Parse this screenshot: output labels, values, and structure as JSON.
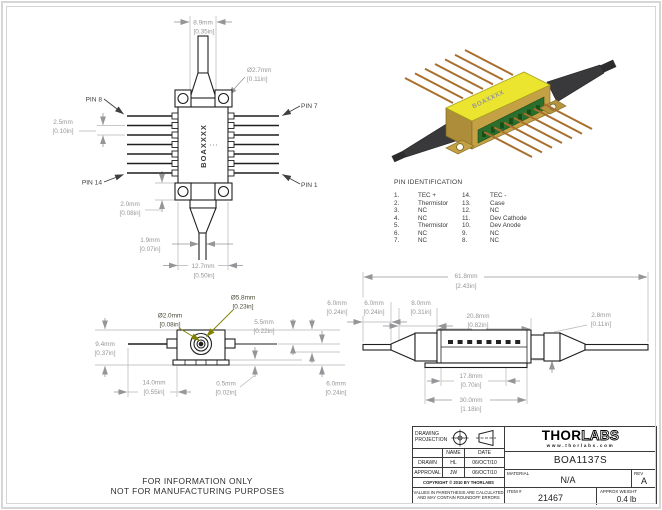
{
  "colors": {
    "part_line": "#1f1f1f",
    "dim_gray": "#96969a",
    "olive_accent": "#7f7f00",
    "lid_yellow": "#ece52f"
  },
  "watermark": {
    "line1": "FOR INFORMATION ONLY",
    "line2": "NOT FOR MANUFACTURING PURPOSES"
  },
  "top_view": {
    "label": "BOAXXXX",
    "pins": {
      "p8": "PIN 8",
      "p7": "PIN 7",
      "p14": "PIN 14",
      "p1": "PIN 1"
    },
    "dims": {
      "width": {
        "mm": "8.9mm",
        "in": "[0.35in]"
      },
      "hole": {
        "mm": "Ø2.7mm",
        "in": "[0.11in]"
      },
      "pitch": {
        "mm": "2.5mm",
        "in": "[0.10in]"
      },
      "ear": {
        "mm": "2.0mm",
        "in": "[0.08in]"
      },
      "boot": {
        "mm": "1.9mm",
        "in": "[0.07in]"
      },
      "body": {
        "mm": "12.7mm",
        "in": "[0.50in]"
      }
    }
  },
  "render": {
    "label": "BOAXXXX"
  },
  "pin_identification": {
    "title": "PIN IDENTIFICATION",
    "left": [
      {
        "n": "1.",
        "f": "TEC +"
      },
      {
        "n": "2.",
        "f": "Thermistor"
      },
      {
        "n": "3.",
        "f": "NC"
      },
      {
        "n": "4.",
        "f": "NC"
      },
      {
        "n": "5.",
        "f": "Thermistor"
      },
      {
        "n": "6.",
        "f": "NC"
      },
      {
        "n": "7.",
        "f": "NC"
      }
    ],
    "right": [
      {
        "n": "14.",
        "f": "TEC -"
      },
      {
        "n": "13.",
        "f": "Case"
      },
      {
        "n": "12.",
        "f": "NC"
      },
      {
        "n": "11.",
        "f": "Dev Cathode"
      },
      {
        "n": "10.",
        "f": "Dev Anode"
      },
      {
        "n": "9.",
        "f": "NC"
      },
      {
        "n": "8.",
        "f": "NC"
      }
    ]
  },
  "end_view": {
    "dims": {
      "lens": {
        "mm": "Ø2.0mm",
        "in": "[0.08in]"
      },
      "aperture": {
        "mm": "Ø5.8mm",
        "in": "[0.23in]"
      },
      "pin_height": {
        "mm": "5.5mm",
        "in": "[0.22in]"
      },
      "top_right": {
        "mm": "6.0mm",
        "in": "[0.24in]"
      },
      "height": {
        "mm": "9.4mm",
        "in": "[0.37in]"
      },
      "width": {
        "mm": "14.0mm",
        "in": "[0.55in]"
      },
      "base": {
        "mm": "0.5mm",
        "in": "[0.02in]"
      },
      "bottom_right": {
        "mm": "6.0mm",
        "in": "[0.24in]"
      }
    }
  },
  "side_view": {
    "dims": {
      "overall": {
        "mm": "61.8mm",
        "in": "[2.43in]"
      },
      "fiber": {
        "mm": "6.0mm",
        "in": "[0.24in]"
      },
      "boot": {
        "mm": "8.0mm",
        "in": "[0.31in]"
      },
      "body": {
        "mm": "20.8mm",
        "in": "[0.82in]"
      },
      "offset": {
        "mm": "2.8mm",
        "in": "[0.11in]"
      },
      "flange_inner": {
        "mm": "17.8mm",
        "in": "[0.70in]"
      },
      "flange": {
        "mm": "30.0mm",
        "in": "[1.18in]"
      }
    }
  },
  "title_block": {
    "projection_line1": "DRAWING",
    "projection_line2": "PROJECTION",
    "col_name": "NAME",
    "col_date": "DATE",
    "drawn_label": "DRAWN",
    "drawn_name": "HL",
    "drawn_date": "06/OCT/10",
    "approval_label": "APPROVAL",
    "approval_name": "JW",
    "approval_date": "06/OCT/10",
    "copyright": "COPYRIGHT © 2010 BY THORLABS",
    "note1": "VALUES IN PARENTHESIS ARE CALCULATED",
    "note2": "AND MAY CONTAIN ROUNDOFF ERRORS",
    "brand_thor": "THOR",
    "brand_labs": "LABS",
    "url": "www.thorlabs.com",
    "part_number": "BOA1137S",
    "material_label": "MATERIAL",
    "material": "N/A",
    "rev_label": "REV",
    "rev": "A",
    "item_label": "ITEM #",
    "item": "21467",
    "weight_label": "APPROX WEIGHT",
    "weight": "0.4 lb"
  }
}
